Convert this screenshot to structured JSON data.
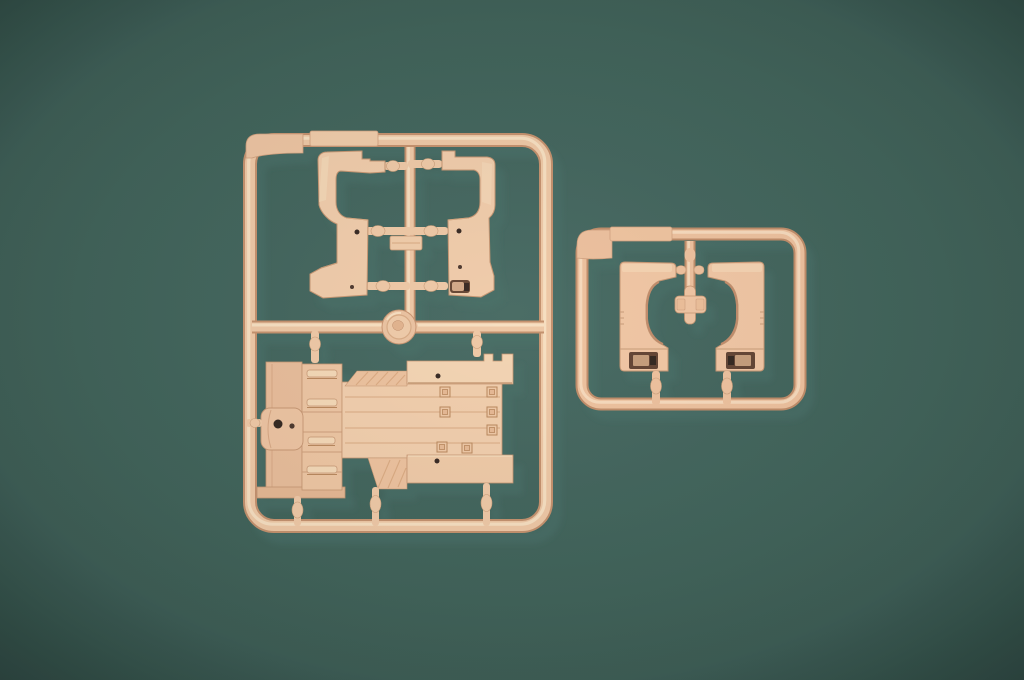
{
  "scene": {
    "title": "Two tan plastic model-kit sprues photographed on a dark green backdrop",
    "media_type": "photograph",
    "colors": {
      "backdrop_center": "#446760",
      "backdrop_edge": "#2e4c46",
      "plastic_base": "#f1c8a5",
      "plastic_highlight": "#f9e0c2",
      "plastic_shade": "#d09c7a",
      "plastic_deep": "#b27e5f",
      "recess_dark": "#5f3f2f",
      "hole_dark": "#30211b",
      "cast_shadow": "#11231f"
    },
    "sprues": [
      {
        "name": "large-sprue",
        "position": "left",
        "part_count": 5,
        "contents": [
          "cab-side-panel-left",
          "cab-side-panel-right",
          "small-connector-block",
          "manufacturer-logo-disc",
          "cargo-bed-deck-with-storage-boxes-and-axle-drum"
        ]
      },
      {
        "name": "small-sprue",
        "position": "right",
        "part_count": 3,
        "contents": [
          "wheel-arch-fender-left",
          "wheel-arch-fender-right",
          "cross-shaped-bracket"
        ]
      }
    ]
  }
}
